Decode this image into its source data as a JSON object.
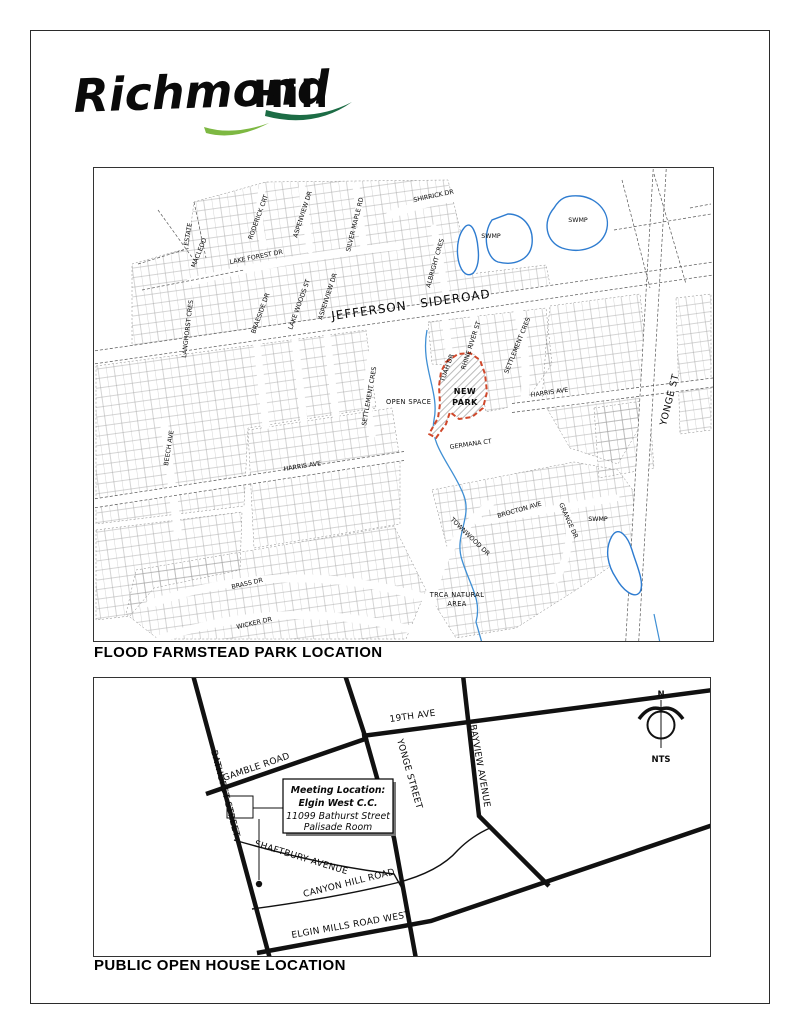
{
  "logo": {
    "script_word": "Richmond",
    "block_word": "Hill"
  },
  "colors": {
    "logo_dark_green": "#1c6c45",
    "logo_light_green": "#7db842",
    "park_outline": "#d0482b",
    "water_blue": "#3f8fd4"
  },
  "map1": {
    "caption": "FLOOD FARMSTEAD PARK LOCATION",
    "labels": {
      "jefferson": "JEFFERSON SIDEROAD",
      "yonge": "YONGE ST",
      "open_space": "OPEN SPACE",
      "park1": "NEW",
      "park2": "PARK",
      "trca1": "TRCA NATURAL",
      "trca2": "AREA",
      "swamp1": "SWMP",
      "swamp2": "SWMP",
      "swamp3": "SWMP"
    },
    "streets": [
      {
        "t": "ESTATE"
      },
      {
        "t": "MACLEOD"
      },
      {
        "t": "RODERICK CRT"
      },
      {
        "t": "ASPENVIEW DR"
      },
      {
        "t": "SILVER MAPLE RD"
      },
      {
        "t": "SHIRRICK DR"
      },
      {
        "t": "LAKE FOREST DR"
      },
      {
        "t": "ALBRIGHT CRES"
      },
      {
        "t": "LAKE WOODS ST"
      },
      {
        "t": "ASPENVIEW DR"
      },
      {
        "t": "BRAESIDE DR"
      },
      {
        "t": "LANGHORST CRES"
      },
      {
        "t": "SETTLEMENT CRES"
      },
      {
        "t": "TUAH DR"
      },
      {
        "t": "RHINE RIVER ST"
      },
      {
        "t": "SETTLEMENT CRES"
      },
      {
        "t": "HARRIS AVE"
      },
      {
        "t": "GERMANA CT"
      },
      {
        "t": "HARRIS AVE"
      },
      {
        "t": "BEECH AVE"
      },
      {
        "t": "BRASS DR"
      },
      {
        "t": "WICKER DR"
      },
      {
        "t": "TOWNWOOD DR"
      },
      {
        "t": "BROCTON AVE"
      },
      {
        "t": "GRANGE DR"
      }
    ]
  },
  "map2": {
    "caption": "PUBLIC OPEN HOUSE LOCATION",
    "roads": [
      {
        "t": "BATHURST STREET"
      },
      {
        "t": "GAMBLE ROAD"
      },
      {
        "t": "YONGE STREET"
      },
      {
        "t": "19TH AVE"
      },
      {
        "t": "BAYVIEW AVENUE"
      },
      {
        "t": "SHAFTBURY AVENUE"
      },
      {
        "t": "CANYON HILL ROAD"
      },
      {
        "t": "ELGIN MILLS ROAD WEST"
      }
    ],
    "callout": [
      "Meeting Location:",
      "Elgin West C.C.",
      "11099 Bathurst Street",
      "Palisade Room"
    ],
    "compass": {
      "n": "N",
      "nts": "NTS"
    }
  }
}
